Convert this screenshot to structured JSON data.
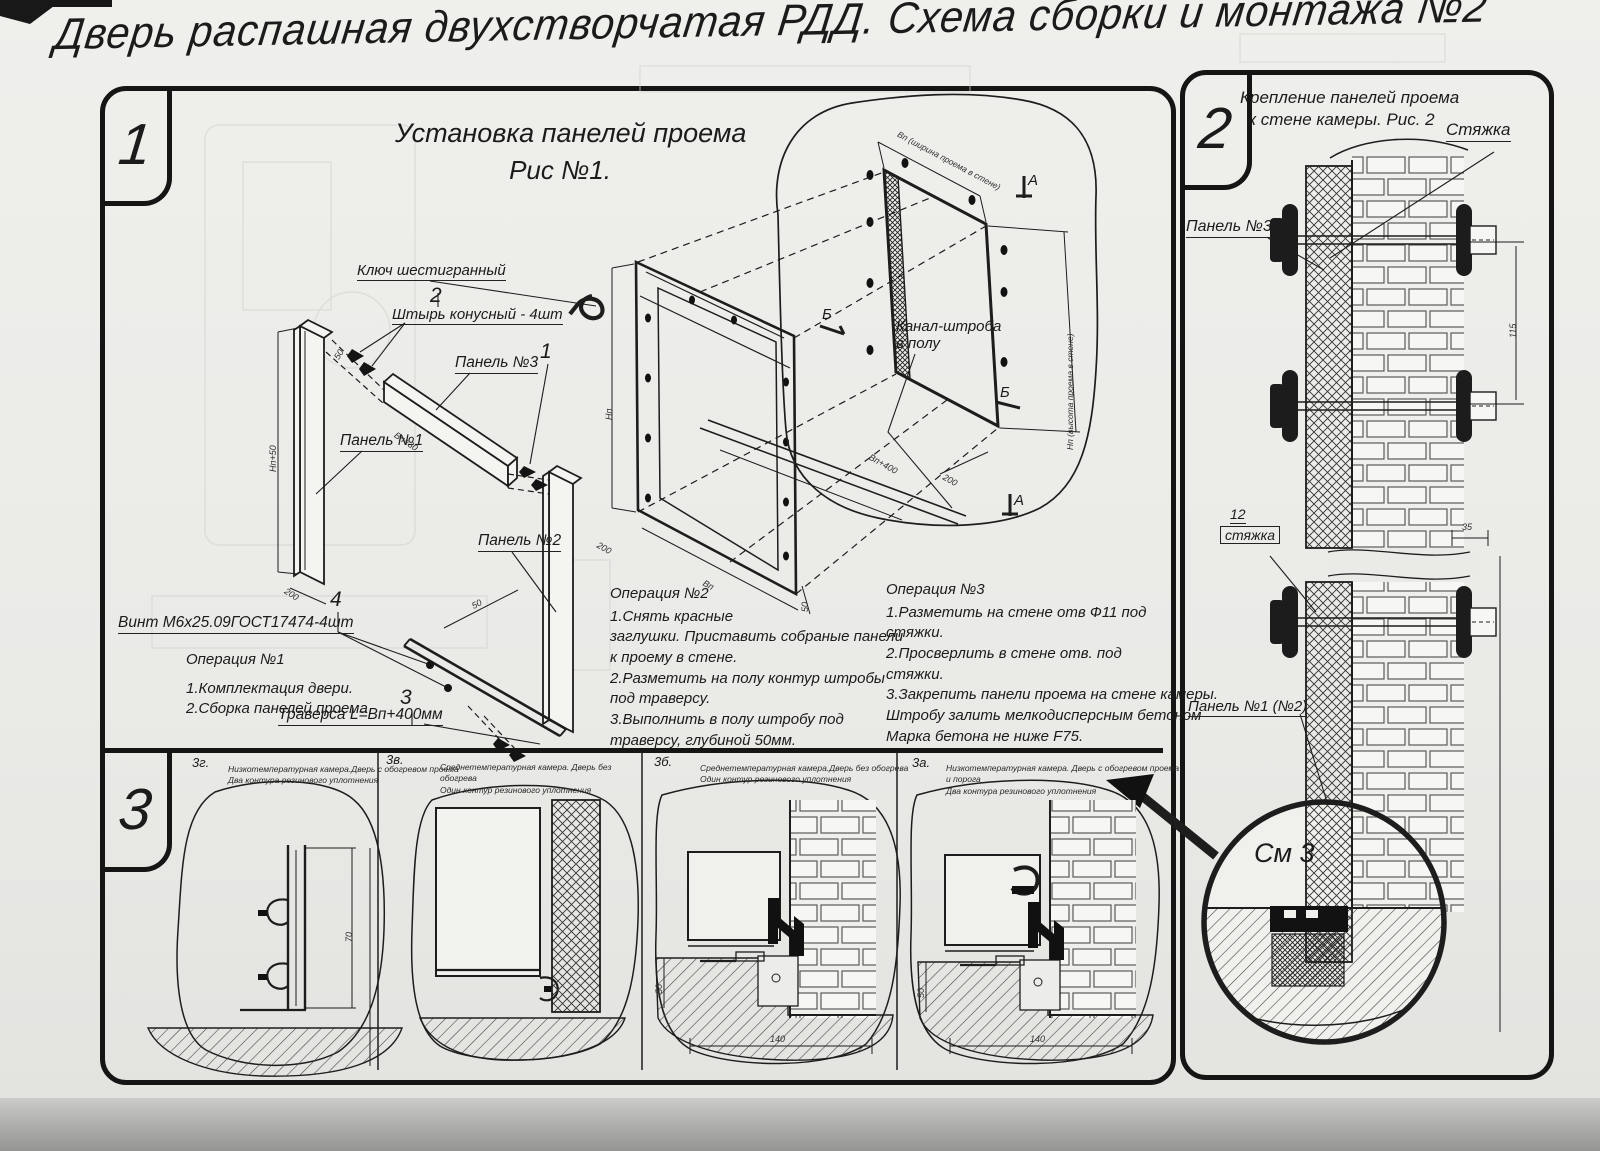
{
  "title": "Дверь распашная двухстворчатая РДД.  Схема сборки и монтажа №2",
  "section1": {
    "badge": "1",
    "title1": "Установка панелей проема",
    "title2": "Рис №1.",
    "labels": {
      "hex_key": "Ключ шестигранный",
      "pin_no": "2",
      "pin": "Штырь конусный - 4шт",
      "panel3": "Панель №3",
      "panel1": "Панель №1",
      "panel2": "Панель №2",
      "assembly_no": "1",
      "screw_no": "4",
      "screw": "Винт М6х25.09ГОСТ17474-4шт",
      "traverse_no": "3",
      "traverse": "Траверса  L=Вп+400мм",
      "channel1": "Канал-штроба",
      "channel2": "в полу",
      "marker_a": "А",
      "marker_b": "Б"
    },
    "dims": {
      "opening_w": "Вп (ширина проема в стене)",
      "opening_h": "Нп (высота проема в стене)",
      "trav_len": "Вп+400",
      "d200": "200",
      "d50": "50",
      "frame_h": "Нп",
      "frame_w": "Вп",
      "panel1_h": "Нп+50",
      "panel3_w": "Вп+30",
      "d70": "70"
    },
    "op1": {
      "title": "Операция №1",
      "lines": [
        "1.Комплектация двери.",
        "2.Сборка панелей проема"
      ]
    },
    "op2": {
      "title": "Операция №2",
      "lines": [
        "1.Снять красные",
        "заглушки. Приставить собраные панели",
        "к проему в стене.",
        "2.Разметить на полу контур штробы",
        "под траверсу.",
        "3.Выполнить в полу штробу под",
        "траверсу, глубиной 50мм."
      ]
    },
    "op3": {
      "title": "Операция №3",
      "lines": [
        "1.Разметить на стене отв Ф11 под",
        "стяжки.",
        "2.Просверлить в стене отв.  под",
        "стяжки.",
        "3.Закрепить панели проема на стене камеры.",
        "Штробу залить мелкодисперсным бетоном",
        "Марка бетона не ниже  F75."
      ]
    }
  },
  "section2": {
    "badge": "2",
    "title1": "Крепление панелей проема",
    "title2": "к стене камеры. Рис. 2",
    "labels": {
      "tie": "Стяжка",
      "panel3": "Панель №3",
      "tie_no": "12",
      "tie2": "стяжка",
      "panel12": "Панель №1 (№2)",
      "see": "См 3"
    },
    "dims": {
      "d35": "35",
      "d115": "115"
    }
  },
  "section3": {
    "badge": "3",
    "panels": [
      {
        "id": "3г.",
        "desc": [
          "Низкотемпературная камера.Дверь с обогревом проема",
          "Два контура резинового уплотнения"
        ],
        "dim_h": "70"
      },
      {
        "id": "3в.",
        "desc": [
          "Среднетемпературная камера. Дверь без обогрева",
          "Один контур резинового уплотнения"
        ]
      },
      {
        "id": "3б.",
        "desc": [
          "Среднетемпературная камера.Дверь без обогрева",
          "Один контур резинового уплотнения"
        ],
        "dim_depth": "50",
        "dim_width": "140"
      },
      {
        "id": "3а.",
        "desc": [
          "Низкотемпературная камера. Дверь с обогревом проема и порога",
          "Два контура резинового уплотнения"
        ],
        "dim_depth": "50",
        "dim_width": "140"
      }
    ]
  }
}
